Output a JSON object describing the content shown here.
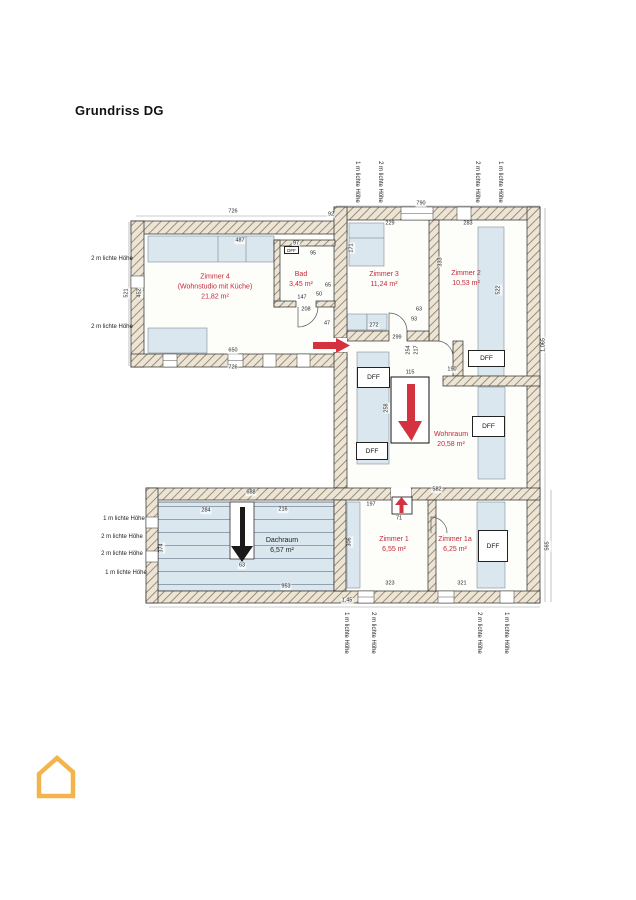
{
  "page": {
    "title": "Grundriss DG"
  },
  "plan": {
    "rooms": [
      {
        "id": "zimmer4",
        "label": "Zimmer 4\n(Wohnstudio mit Küche)\n21,82 m²"
      },
      {
        "id": "bad",
        "label": "Bad\n3,45 m²"
      },
      {
        "id": "zimmer3",
        "label": "Zimmer 3\n11,24 m²"
      },
      {
        "id": "zimmer2",
        "label": "Zimmer 2\n10,53 m²"
      },
      {
        "id": "wohnraum",
        "label": "Wohnraum\n20,58 m²"
      },
      {
        "id": "zimmer1",
        "label": "Zimmer 1\n6,55 m²"
      },
      {
        "id": "zimmer1a",
        "label": "Zimmer 1a\n6,25 m²"
      },
      {
        "id": "dachraum",
        "label": "Dachraum\n6,57 m²"
      }
    ],
    "dff_boxes": [
      {
        "label": "DFF",
        "x": 284,
        "y": 246,
        "w": 15,
        "h": 8,
        "fs": 4.5
      },
      {
        "label": "DFF",
        "x": 468,
        "y": 350,
        "w": 37,
        "h": 17
      },
      {
        "label": "DFF",
        "x": 357,
        "y": 367,
        "w": 33,
        "h": 21
      },
      {
        "label": "DFF",
        "x": 356,
        "y": 442,
        "w": 32,
        "h": 18
      },
      {
        "label": "DFF",
        "x": 472,
        "y": 416,
        "w": 33,
        "h": 21
      },
      {
        "label": "DFF",
        "x": 478,
        "y": 530,
        "w": 30,
        "h": 32
      }
    ],
    "height_labels": [
      {
        "t": "1 m lichte Höhe",
        "x": 357,
        "y": 182,
        "r": 1
      },
      {
        "t": "2 m lichte Höhe",
        "x": 380,
        "y": 182,
        "r": 1
      },
      {
        "t": "2 m lichte Höhe",
        "x": 477,
        "y": 182,
        "r": 1
      },
      {
        "t": "1 m lichte Höhe",
        "x": 500,
        "y": 182,
        "r": 1
      },
      {
        "t": "1 m lichte Höhe",
        "x": 346,
        "y": 633,
        "r": 1
      },
      {
        "t": "2 m lichte Höhe",
        "x": 373,
        "y": 633,
        "r": 1
      },
      {
        "t": "2 m lichte Höhe",
        "x": 479,
        "y": 633,
        "r": 1
      },
      {
        "t": "1 m lichte Höhe",
        "x": 506,
        "y": 633,
        "r": 1
      },
      {
        "t": "2 m lichte Höhe",
        "x": 112,
        "y": 259
      },
      {
        "t": "2 m lichte Höhe",
        "x": 112,
        "y": 327
      },
      {
        "t": "1 m lichte Höhe",
        "x": 124,
        "y": 519
      },
      {
        "t": "2 m lichte Höhe",
        "x": 122,
        "y": 537
      },
      {
        "t": "2 m lichte Höhe",
        "x": 122,
        "y": 554
      },
      {
        "t": "1 m lichte Höhe",
        "x": 126,
        "y": 573
      }
    ],
    "dimensions": [
      {
        "t": "726",
        "x": 233,
        "y": 212
      },
      {
        "t": "92",
        "x": 331,
        "y": 215
      },
      {
        "t": "790",
        "x": 421,
        "y": 204
      },
      {
        "t": "521",
        "x": 127,
        "y": 293,
        "r": 1
      },
      {
        "t": "452",
        "x": 140,
        "y": 293,
        "r": 1
      },
      {
        "t": "487",
        "x": 240,
        "y": 241
      },
      {
        "t": "650",
        "x": 233,
        "y": 351
      },
      {
        "t": "726",
        "x": 233,
        "y": 368
      },
      {
        "t": "97",
        "x": 296,
        "y": 244
      },
      {
        "t": "95",
        "x": 313,
        "y": 254
      },
      {
        "t": "147",
        "x": 302,
        "y": 298
      },
      {
        "t": "208",
        "x": 306,
        "y": 310
      },
      {
        "t": "65",
        "x": 328,
        "y": 286
      },
      {
        "t": "50",
        "x": 319,
        "y": 295
      },
      {
        "t": "47",
        "x": 327,
        "y": 324
      },
      {
        "t": "272",
        "x": 374,
        "y": 326
      },
      {
        "t": "299",
        "x": 397,
        "y": 338
      },
      {
        "t": "63",
        "x": 419,
        "y": 310
      },
      {
        "t": "93",
        "x": 414,
        "y": 320
      },
      {
        "t": "229",
        "x": 390,
        "y": 224
      },
      {
        "t": "171",
        "x": 352,
        "y": 248,
        "r": 1
      },
      {
        "t": "283",
        "x": 468,
        "y": 224
      },
      {
        "t": "333",
        "x": 441,
        "y": 262,
        "r": 1
      },
      {
        "t": "522",
        "x": 499,
        "y": 290,
        "r": 1
      },
      {
        "t": "217",
        "x": 417,
        "y": 350,
        "r": 1
      },
      {
        "t": "254",
        "x": 409,
        "y": 350,
        "r": 1
      },
      {
        "t": "115",
        "x": 410,
        "y": 373
      },
      {
        "t": "258",
        "x": 387,
        "y": 408,
        "r": 1
      },
      {
        "t": "582",
        "x": 437,
        "y": 490
      },
      {
        "t": "190",
        "x": 452,
        "y": 370
      },
      {
        "t": "1,065",
        "x": 544,
        "y": 345,
        "r": 1
      },
      {
        "t": "565",
        "x": 548,
        "y": 546,
        "r": 1
      },
      {
        "t": "688",
        "x": 251,
        "y": 493
      },
      {
        "t": "284",
        "x": 206,
        "y": 511
      },
      {
        "t": "216",
        "x": 283,
        "y": 510
      },
      {
        "t": "374",
        "x": 162,
        "y": 548,
        "r": 1
      },
      {
        "t": "63",
        "x": 242,
        "y": 566
      },
      {
        "t": "953",
        "x": 286,
        "y": 587
      },
      {
        "t": "197",
        "x": 371,
        "y": 505
      },
      {
        "t": "71",
        "x": 399,
        "y": 519
      },
      {
        "t": "306",
        "x": 350,
        "y": 542,
        "r": 1
      },
      {
        "t": "323",
        "x": 390,
        "y": 584
      },
      {
        "t": "321",
        "x": 462,
        "y": 584
      },
      {
        "t": "1,45",
        "x": 347,
        "y": 601
      }
    ],
    "colors": {
      "wall_hatch": "#8d7e65",
      "wall_bg": "#ece5d6",
      "low_area_blue": "#dbe7ef",
      "room_label_red": "#c2293a",
      "arrow_red": "#d4323e",
      "logo_orange": "#f4b44c"
    }
  }
}
